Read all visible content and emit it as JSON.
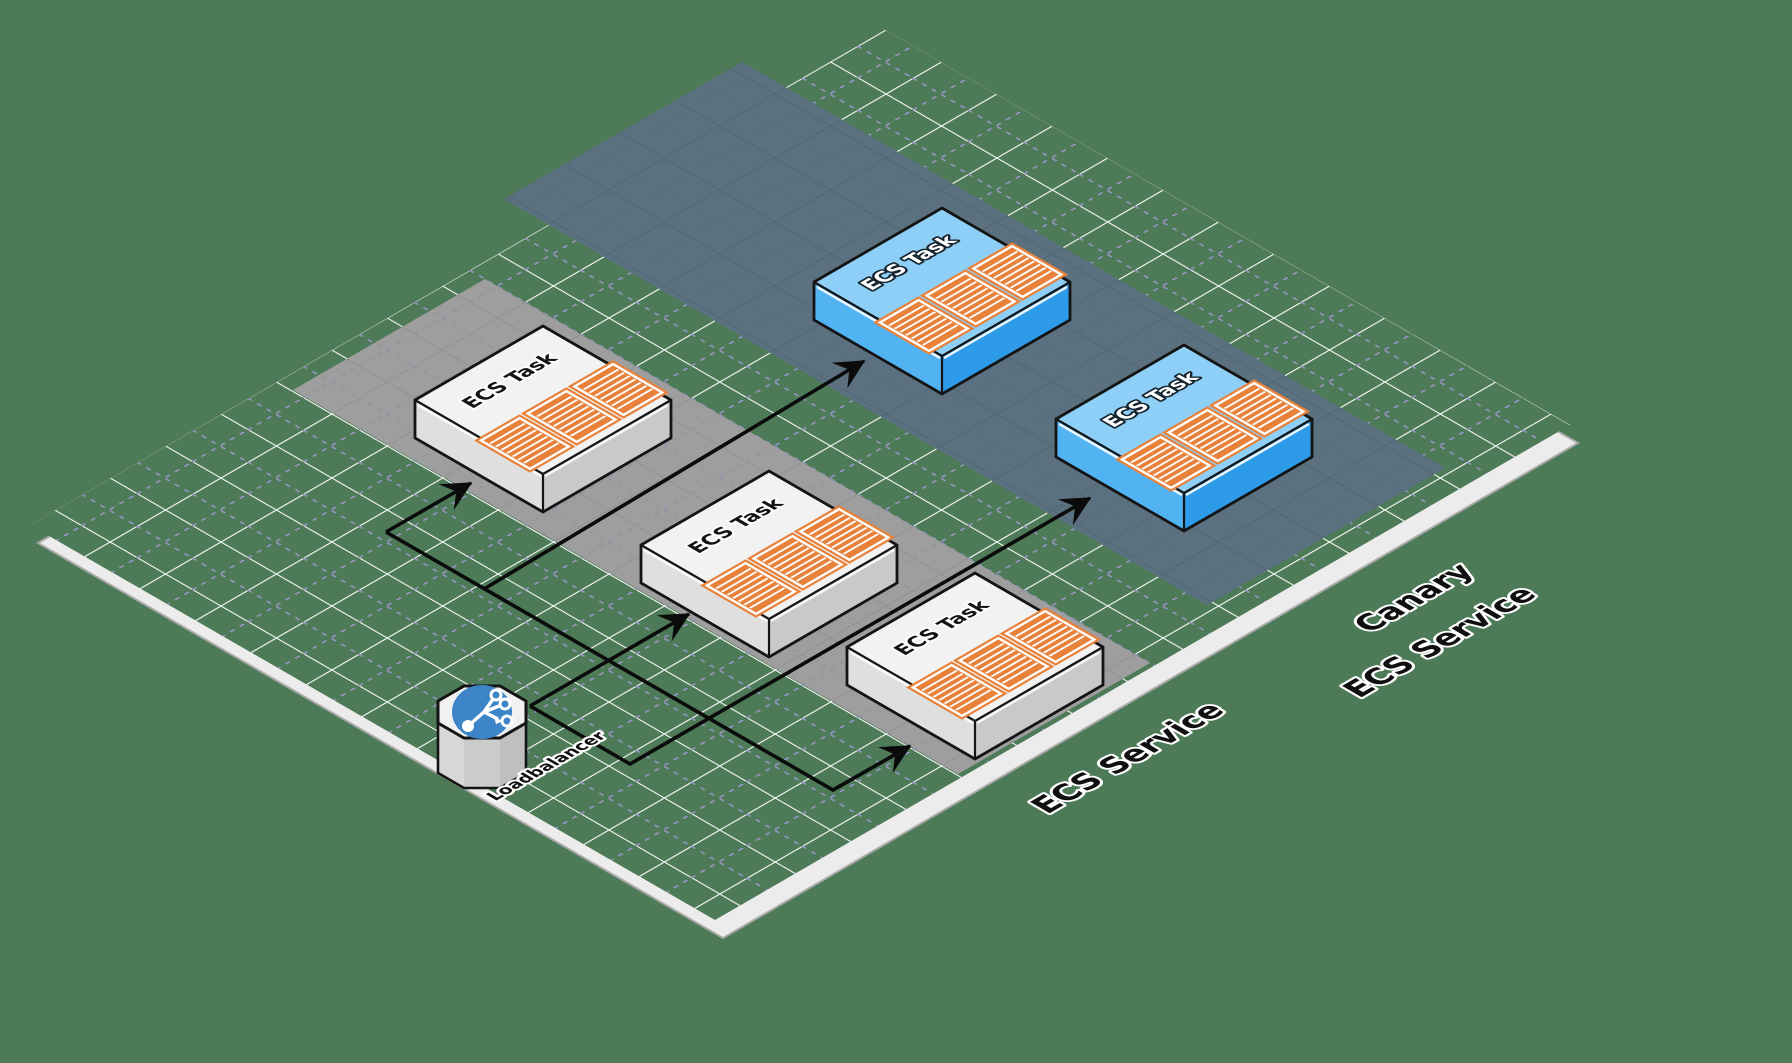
{
  "diagram": {
    "task_count": 5,
    "labels": {
      "load_balancer": "Loadbalancer",
      "ecs_service": "ECS Service",
      "canary_service_line1": "Canary",
      "canary_service_line2": "ECS Service"
    },
    "nodes": [
      {
        "id": "ecs-task-1",
        "label": "ECS Task",
        "service": "ECS Service",
        "variant": "standard",
        "containers": 3
      },
      {
        "id": "ecs-task-2",
        "label": "ECS Task",
        "service": "ECS Service",
        "variant": "standard",
        "containers": 3
      },
      {
        "id": "ecs-task-3",
        "label": "ECS Task",
        "service": "ECS Service",
        "variant": "standard",
        "containers": 3
      },
      {
        "id": "canary-task-1",
        "label": "ECS Task",
        "service": "Canary ECS Service",
        "variant": "canary",
        "containers": 3
      },
      {
        "id": "canary-task-2",
        "label": "ECS Task",
        "service": "Canary ECS Service",
        "variant": "canary",
        "containers": 3
      },
      {
        "id": "load-balancer",
        "label": "Loadbalancer",
        "type": "load-balancer"
      }
    ],
    "edges": [
      {
        "from": "load-balancer",
        "to": "ecs-task-1"
      },
      {
        "from": "load-balancer",
        "to": "ecs-task-2"
      },
      {
        "from": "load-balancer",
        "to": "ecs-task-3"
      },
      {
        "from": "load-balancer",
        "to": "canary-task-1"
      },
      {
        "from": "load-balancer",
        "to": "canary-task-2"
      }
    ],
    "colors": {
      "plane": "#4d7a57",
      "grid_line": "#ffffff",
      "grid_dash": "#9b97c9",
      "service_band": "#9e9e9e",
      "canary_band": "#5b7180",
      "task_top": "#f2f2f2",
      "canary_task_top": "#8ecff7",
      "container": "#e8823b",
      "lb_icon_circle": "#3e85c8",
      "arrow": "#0b0b0b"
    }
  }
}
